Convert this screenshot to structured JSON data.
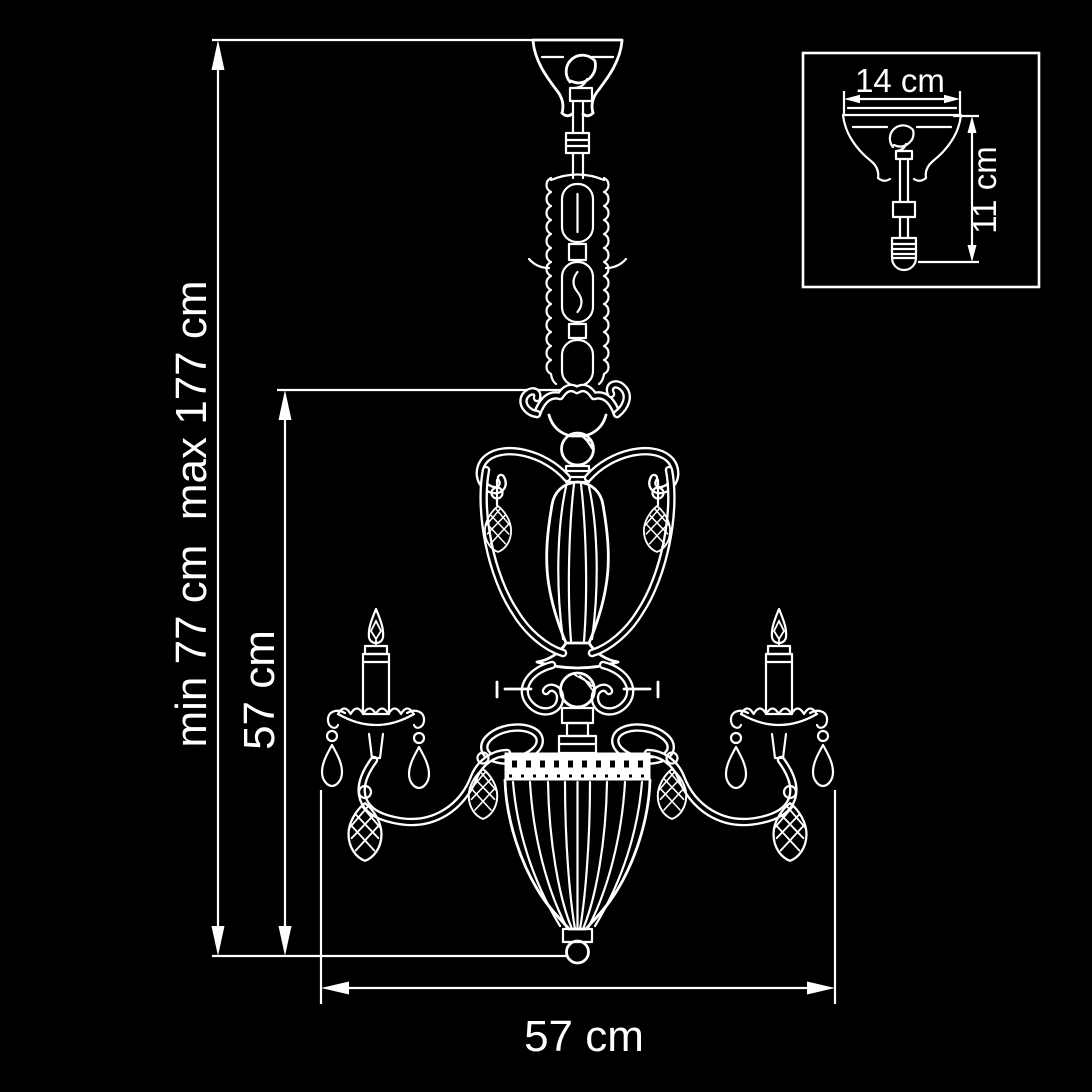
{
  "colors": {
    "background": "#000000",
    "line": "#ffffff"
  },
  "labels": {
    "overall_height": "min 77 cm  max 177 cm",
    "body_height": "57 cm",
    "width": "57 cm",
    "canopy_width": "14 cm",
    "canopy_height": "11 cm"
  }
}
